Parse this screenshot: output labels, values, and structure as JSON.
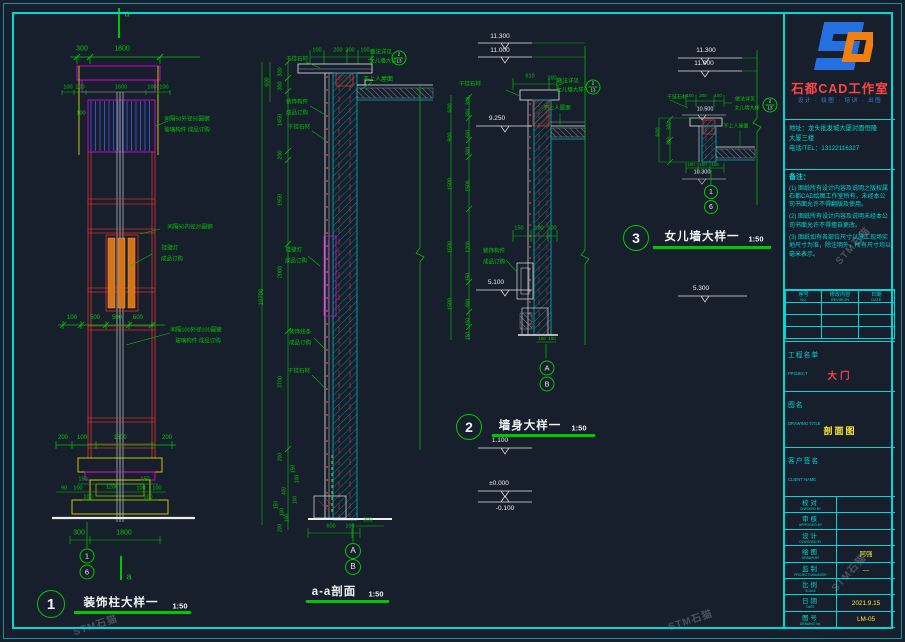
{
  "panel": {
    "studio_name": "石都CAD工作室",
    "tagline": "设计 · 绘图 · 培训 · 出图",
    "address_line1": "地址：龙头批发城大厦对面恒隆",
    "address_line2": "大厦三楼",
    "phone": "电话/TEL：13122116327",
    "notes_title": "备注：",
    "notes": [
      "(1) 图纸所有设计内容及说明之版权属石都CAD绘图工作室所有，未经本公司书面允许不得翻版及使用。",
      "(2) 图纸所有设计内容及说明未经本公司书面允许不得擅自更改。",
      "(3) 图纸如有各部位尺寸以施工现场实地尺寸为准，除注明外，所有尺寸均以毫米表示。"
    ],
    "revision_headers": [
      {
        "cn": "序号",
        "en": "NO."
      },
      {
        "cn": "修改内容",
        "en": "REVISION"
      },
      {
        "cn": "日期",
        "en": "DATE"
      }
    ],
    "revision_empty_rows": 3,
    "project": {
      "cn": "工程名单",
      "en": "PROJECT",
      "value": "大门"
    },
    "drawing": {
      "cn": "图名",
      "en": "DRAWING TITLE",
      "value": "剖面图"
    },
    "client": {
      "cn": "客户签名",
      "en": "CLIENT NAME",
      "value": ""
    },
    "personnel": [
      {
        "cn": "校对",
        "en": "CHECKED BY",
        "value": ""
      },
      {
        "cn": "审核",
        "en": "APPROVED BY",
        "value": ""
      },
      {
        "cn": "设计",
        "en": "DESIGNED BY",
        "value": ""
      },
      {
        "cn": "绘图",
        "en": "DRAWN BY",
        "value": "阿强"
      },
      {
        "cn": "监制",
        "en": "PROJECT MANAGER",
        "value": "—"
      },
      {
        "cn": "比例",
        "en": "SCALE",
        "value": ""
      },
      {
        "cn": "日期",
        "en": "DATE",
        "value": "2021.9.15"
      },
      {
        "cn": "图号",
        "en": "DRAWING No.",
        "value": "LM-05"
      }
    ]
  },
  "titles": [
    {
      "bubble": "1",
      "text": "装饰柱大样一",
      "scale": "1:50"
    },
    {
      "bubble": "",
      "text": "a-a剖面",
      "scale": "1:50"
    },
    {
      "bubble": "2",
      "text": "墙身大样一",
      "scale": "1:50"
    },
    {
      "bubble": "3",
      "text": "女儿墙大样一",
      "scale": "1:50"
    }
  ],
  "callout": {
    "top": "2",
    "bottom": "13",
    "items": [
      {
        "x": 399,
        "y": 58
      },
      {
        "x": 593,
        "y": 87
      },
      {
        "x": 770,
        "y": 105
      }
    ]
  },
  "bubbles": [
    {
      "t": "1",
      "x": 87,
      "y": 556,
      "r": 6.5
    },
    {
      "t": "6",
      "x": 87,
      "y": 572,
      "r": 6.5
    },
    {
      "t": "A",
      "x": 353,
      "y": 551,
      "r": 7
    },
    {
      "t": "B",
      "x": 353,
      "y": 567,
      "r": 7
    },
    {
      "t": "A",
      "x": 547,
      "y": 368,
      "r": 6.5
    },
    {
      "t": "B",
      "x": 547,
      "y": 384,
      "r": 6.5
    },
    {
      "t": "1",
      "x": 711,
      "y": 192,
      "r": 6
    },
    {
      "t": "6",
      "x": 711,
      "y": 207,
      "r": 6
    }
  ],
  "watermarks": {
    "text": "STM石猫",
    "items": [
      {
        "x": 95,
        "y": 624,
        "rot": -18
      },
      {
        "x": 690,
        "y": 619,
        "rot": -18
      },
      {
        "x": 848,
        "y": 572,
        "rot": -48
      },
      {
        "x": 852,
        "y": 245,
        "rot": -48
      }
    ]
  },
  "annotations": [
    {
      "t": "a",
      "x": 127,
      "y": 14,
      "s": 9
    },
    {
      "t": "300",
      "x": 82,
      "y": 49
    },
    {
      "t": "1800",
      "x": 122,
      "y": 49
    },
    {
      "t": "100",
      "x": 68,
      "y": 88,
      "s": 5.5
    },
    {
      "t": "100",
      "x": 80,
      "y": 88,
      "s": 5.5
    },
    {
      "t": "1600",
      "x": 121,
      "y": 88,
      "s": 5.5
    },
    {
      "t": "100",
      "x": 152,
      "y": 88,
      "s": 5.5
    },
    {
      "t": "100",
      "x": 164,
      "y": 88,
      "s": 5.5
    },
    {
      "t": "100",
      "x": 81,
      "y": 114,
      "s": 5.5
    },
    {
      "t": "间隔50外径50圆钢",
      "x": 187,
      "y": 120,
      "s": 5.5
    },
    {
      "t": "玻璃构件 成品订购",
      "x": 187,
      "y": 131,
      "s": 5.5
    },
    {
      "t": "间隔50内径20圆钢",
      "x": 190,
      "y": 228,
      "s": 5.5
    },
    {
      "t": "挂壁灯",
      "x": 170,
      "y": 249,
      "s": 5.5
    },
    {
      "t": "成品订购",
      "x": 172,
      "y": 260,
      "s": 5.5
    },
    {
      "t": "100",
      "x": 72,
      "y": 318,
      "s": 6
    },
    {
      "t": "500",
      "x": 95,
      "y": 318,
      "s": 6
    },
    {
      "t": "500",
      "x": 117,
      "y": 318,
      "s": 6
    },
    {
      "t": "600",
      "x": 138,
      "y": 318,
      "s": 6
    },
    {
      "t": "间隔100外径100圆管",
      "x": 196,
      "y": 331,
      "s": 5.5
    },
    {
      "t": "玻璃构件 成品订购",
      "x": 198,
      "y": 342,
      "s": 5.5
    },
    {
      "t": "200",
      "x": 63,
      "y": 438,
      "s": 6
    },
    {
      "t": "100",
      "x": 82,
      "y": 438,
      "s": 6
    },
    {
      "t": "1600",
      "x": 120,
      "y": 438,
      "s": 6
    },
    {
      "t": "200",
      "x": 167,
      "y": 438,
      "s": 6
    },
    {
      "t": "150",
      "x": 83,
      "y": 480,
      "s": 5.5
    },
    {
      "t": "150",
      "x": 145,
      "y": 480,
      "s": 5.5
    },
    {
      "t": "90",
      "x": 64,
      "y": 489,
      "s": 5.5
    },
    {
      "t": "100",
      "x": 78,
      "y": 489,
      "s": 5.5
    },
    {
      "t": "1200",
      "x": 112,
      "y": 488,
      "s": 5.5
    },
    {
      "t": "100",
      "x": 141,
      "y": 489,
      "s": 5.5
    },
    {
      "t": "100",
      "x": 157,
      "y": 489,
      "s": 5.5
    },
    {
      "t": "100",
      "x": 88,
      "y": 498,
      "s": 5.5
    },
    {
      "t": "100",
      "x": 148,
      "y": 498,
      "s": 5.5
    },
    {
      "t": "300",
      "x": 79,
      "y": 533
    },
    {
      "t": "1800",
      "x": 124,
      "y": 533
    },
    {
      "t": "a",
      "x": 129,
      "y": 577,
      "s": 9
    },
    {
      "t": "100",
      "x": 317,
      "y": 51,
      "s": 5.5
    },
    {
      "t": "200",
      "x": 338,
      "y": 51,
      "s": 5.5
    },
    {
      "t": "300",
      "x": 350,
      "y": 51,
      "s": 5.5
    },
    {
      "t": "100",
      "x": 365,
      "y": 51,
      "s": 5.5
    },
    {
      "t": "干挂石材",
      "x": 297,
      "y": 60,
      "s": 5.5
    },
    {
      "t": "做法详见",
      "x": 381,
      "y": 53,
      "s": 5.5
    },
    {
      "t": "女儿墙大样",
      "x": 383,
      "y": 62,
      "s": 5.5
    },
    {
      "t": "不上人屋面",
      "x": 378,
      "y": 80,
      "s": 6
    },
    {
      "t": "600",
      "x": 268,
      "y": 82,
      "r": 1,
      "s": 5.5
    },
    {
      "t": "300",
      "x": 281,
      "y": 72,
      "r": 1,
      "s": 5.5
    },
    {
      "t": "300",
      "x": 281,
      "y": 86,
      "r": 1,
      "s": 5.5
    },
    {
      "t": "1450",
      "x": 281,
      "y": 120,
      "r": 1,
      "s": 5.5
    },
    {
      "t": "200",
      "x": 281,
      "y": 155,
      "r": 1,
      "s": 5.5
    },
    {
      "t": "1950",
      "x": 281,
      "y": 200,
      "r": 1,
      "s": 5.5
    },
    {
      "t": "2000",
      "x": 281,
      "y": 272,
      "r": 1,
      "s": 5.5
    },
    {
      "t": "3700",
      "x": 281,
      "y": 382,
      "r": 1,
      "s": 5.5
    },
    {
      "t": "10700",
      "x": 262,
      "y": 297,
      "r": 1,
      "s": 6
    },
    {
      "t": "装饰构件",
      "x": 297,
      "y": 103,
      "s": 5.5
    },
    {
      "t": "成品订购",
      "x": 297,
      "y": 114,
      "s": 5.5
    },
    {
      "t": "干挂石材",
      "x": 299,
      "y": 128,
      "s": 5.5
    },
    {
      "t": "挂壁灯",
      "x": 294,
      "y": 251,
      "s": 5.5
    },
    {
      "t": "成品订购",
      "x": 296,
      "y": 262,
      "s": 5.5
    },
    {
      "t": "装饰线条",
      "x": 300,
      "y": 333,
      "s": 5.5
    },
    {
      "t": "成品订购",
      "x": 300,
      "y": 344,
      "s": 5.5
    },
    {
      "t": "干挂石材",
      "x": 299,
      "y": 372,
      "s": 5.5
    },
    {
      "t": "200",
      "x": 281,
      "y": 457,
      "r": 1,
      "s": 5
    },
    {
      "t": "150",
      "x": 294,
      "y": 469,
      "r": 1,
      "s": 5
    },
    {
      "t": "100",
      "x": 298,
      "y": 479,
      "r": 1,
      "s": 5
    },
    {
      "t": "400",
      "x": 285,
      "y": 491,
      "r": 1,
      "s": 5
    },
    {
      "t": "100",
      "x": 296,
      "y": 500,
      "r": 1,
      "s": 5
    },
    {
      "t": "150",
      "x": 277,
      "y": 505,
      "r": 1,
      "s": 5
    },
    {
      "t": "100",
      "x": 283,
      "y": 512,
      "r": 1,
      "s": 5
    },
    {
      "t": "100",
      "x": 288,
      "y": 518,
      "r": 1,
      "s": 5
    },
    {
      "t": "200",
      "x": 281,
      "y": 528,
      "r": 1,
      "s": 5
    },
    {
      "t": "600",
      "x": 331,
      "y": 527,
      "s": 5.5
    },
    {
      "t": "100",
      "x": 350,
      "y": 527,
      "s": 5.5
    },
    {
      "t": "300",
      "x": 368,
      "y": 521,
      "s": 5.5
    },
    {
      "t": "11.300",
      "x": 500,
      "y": 37,
      "c": "w",
      "s": 6.5
    },
    {
      "t": "11.000",
      "x": 500,
      "y": 51,
      "c": "w",
      "s": 6.5
    },
    {
      "t": "610",
      "x": 530,
      "y": 77,
      "s": 5.5
    },
    {
      "t": "100",
      "x": 552,
      "y": 79,
      "s": 5.5
    },
    {
      "t": "干挂石材",
      "x": 470,
      "y": 85,
      "s": 5.5
    },
    {
      "t": "做法详见",
      "x": 568,
      "y": 82,
      "s": 5.5
    },
    {
      "t": "女儿墙大样",
      "x": 570,
      "y": 91,
      "s": 5.5
    },
    {
      "t": "不上人屋面",
      "x": 557,
      "y": 109,
      "s": 5.5
    },
    {
      "t": "9.250",
      "x": 497,
      "y": 119,
      "c": "w",
      "s": 6.5
    },
    {
      "t": "600",
      "x": 451,
      "y": 108,
      "r": 1,
      "s": 5.5
    },
    {
      "t": "900",
      "x": 451,
      "y": 137,
      "r": 1,
      "s": 5.5
    },
    {
      "t": "1500",
      "x": 451,
      "y": 184,
      "r": 1,
      "s": 5.5
    },
    {
      "t": "1500",
      "x": 451,
      "y": 247,
      "r": 1,
      "s": 5.5
    },
    {
      "t": "1500",
      "x": 451,
      "y": 304,
      "r": 1,
      "s": 5.5
    },
    {
      "t": "300",
      "x": 469,
      "y": 101,
      "r": 1,
      "s": 5
    },
    {
      "t": "300",
      "x": 469,
      "y": 113,
      "r": 1,
      "s": 5
    },
    {
      "t": "600",
      "x": 469,
      "y": 134,
      "r": 1,
      "s": 5
    },
    {
      "t": "300",
      "x": 469,
      "y": 151,
      "r": 1,
      "s": 5
    },
    {
      "t": "1500",
      "x": 469,
      "y": 186,
      "r": 1,
      "s": 5
    },
    {
      "t": "1200",
      "x": 469,
      "y": 247,
      "r": 1,
      "s": 5
    },
    {
      "t": "150",
      "x": 469,
      "y": 277,
      "r": 1,
      "s": 5
    },
    {
      "t": "900",
      "x": 469,
      "y": 303,
      "r": 1,
      "s": 5
    },
    {
      "t": "150",
      "x": 469,
      "y": 322,
      "r": 1,
      "s": 5
    },
    {
      "t": "150",
      "x": 469,
      "y": 336,
      "r": 1,
      "s": 5
    },
    {
      "t": "150",
      "x": 519,
      "y": 229,
      "s": 5.5
    },
    {
      "t": "100",
      "x": 539,
      "y": 229,
      "s": 5.5
    },
    {
      "t": "100",
      "x": 552,
      "y": 229,
      "s": 5.5
    },
    {
      "t": "装饰构件",
      "x": 494,
      "y": 252,
      "s": 5.5
    },
    {
      "t": "成品订购",
      "x": 494,
      "y": 263,
      "s": 5.5
    },
    {
      "t": "5.100",
      "x": 496,
      "y": 283,
      "c": "w",
      "s": 6.5
    },
    {
      "t": "100",
      "x": 542,
      "y": 339,
      "s": 4.5
    },
    {
      "t": "100",
      "x": 552,
      "y": 339,
      "s": 4.5
    },
    {
      "t": "1.100",
      "x": 500,
      "y": 441,
      "c": "w",
      "s": 6.5
    },
    {
      "t": "±0.000",
      "x": 499,
      "y": 484,
      "c": "w",
      "s": 6.5
    },
    {
      "t": "-0.100",
      "x": 505,
      "y": 509,
      "c": "w",
      "s": 6.5
    },
    {
      "t": "11.300",
      "x": 706,
      "y": 51,
      "c": "w",
      "s": 6.5
    },
    {
      "t": "11.000",
      "x": 704,
      "y": 64,
      "c": "w",
      "s": 6.5
    },
    {
      "t": "干挂石材",
      "x": 677,
      "y": 98,
      "s": 5
    },
    {
      "t": "100",
      "x": 690,
      "y": 96,
      "s": 4.5
    },
    {
      "t": "200",
      "x": 703,
      "y": 96,
      "s": 4.5
    },
    {
      "t": "100",
      "x": 718,
      "y": 96,
      "s": 4.5
    },
    {
      "t": "10.500",
      "x": 705,
      "y": 110,
      "c": "w",
      "s": 5.5
    },
    {
      "t": "做法详见",
      "x": 745,
      "y": 100,
      "s": 5
    },
    {
      "t": "女儿墙大样",
      "x": 747,
      "y": 109,
      "s": 5
    },
    {
      "t": "600",
      "x": 659,
      "y": 132,
      "r": 1,
      "s": 5.5
    },
    {
      "t": "300",
      "x": 670,
      "y": 126,
      "r": 1,
      "s": 5
    },
    {
      "t": "300",
      "x": 670,
      "y": 141,
      "r": 1,
      "s": 5
    },
    {
      "t": "不上人屋面",
      "x": 736,
      "y": 127,
      "s": 5
    },
    {
      "t": "100",
      "x": 691,
      "y": 165,
      "s": 4.5
    },
    {
      "t": "100",
      "x": 703,
      "y": 165,
      "s": 4.5
    },
    {
      "t": "100",
      "x": 715,
      "y": 165,
      "s": 4.5
    },
    {
      "t": "10.300",
      "x": 702,
      "y": 173,
      "c": "w",
      "s": 5.5
    },
    {
      "t": "5.300",
      "x": 701,
      "y": 289,
      "c": "w",
      "s": 6.5
    }
  ]
}
